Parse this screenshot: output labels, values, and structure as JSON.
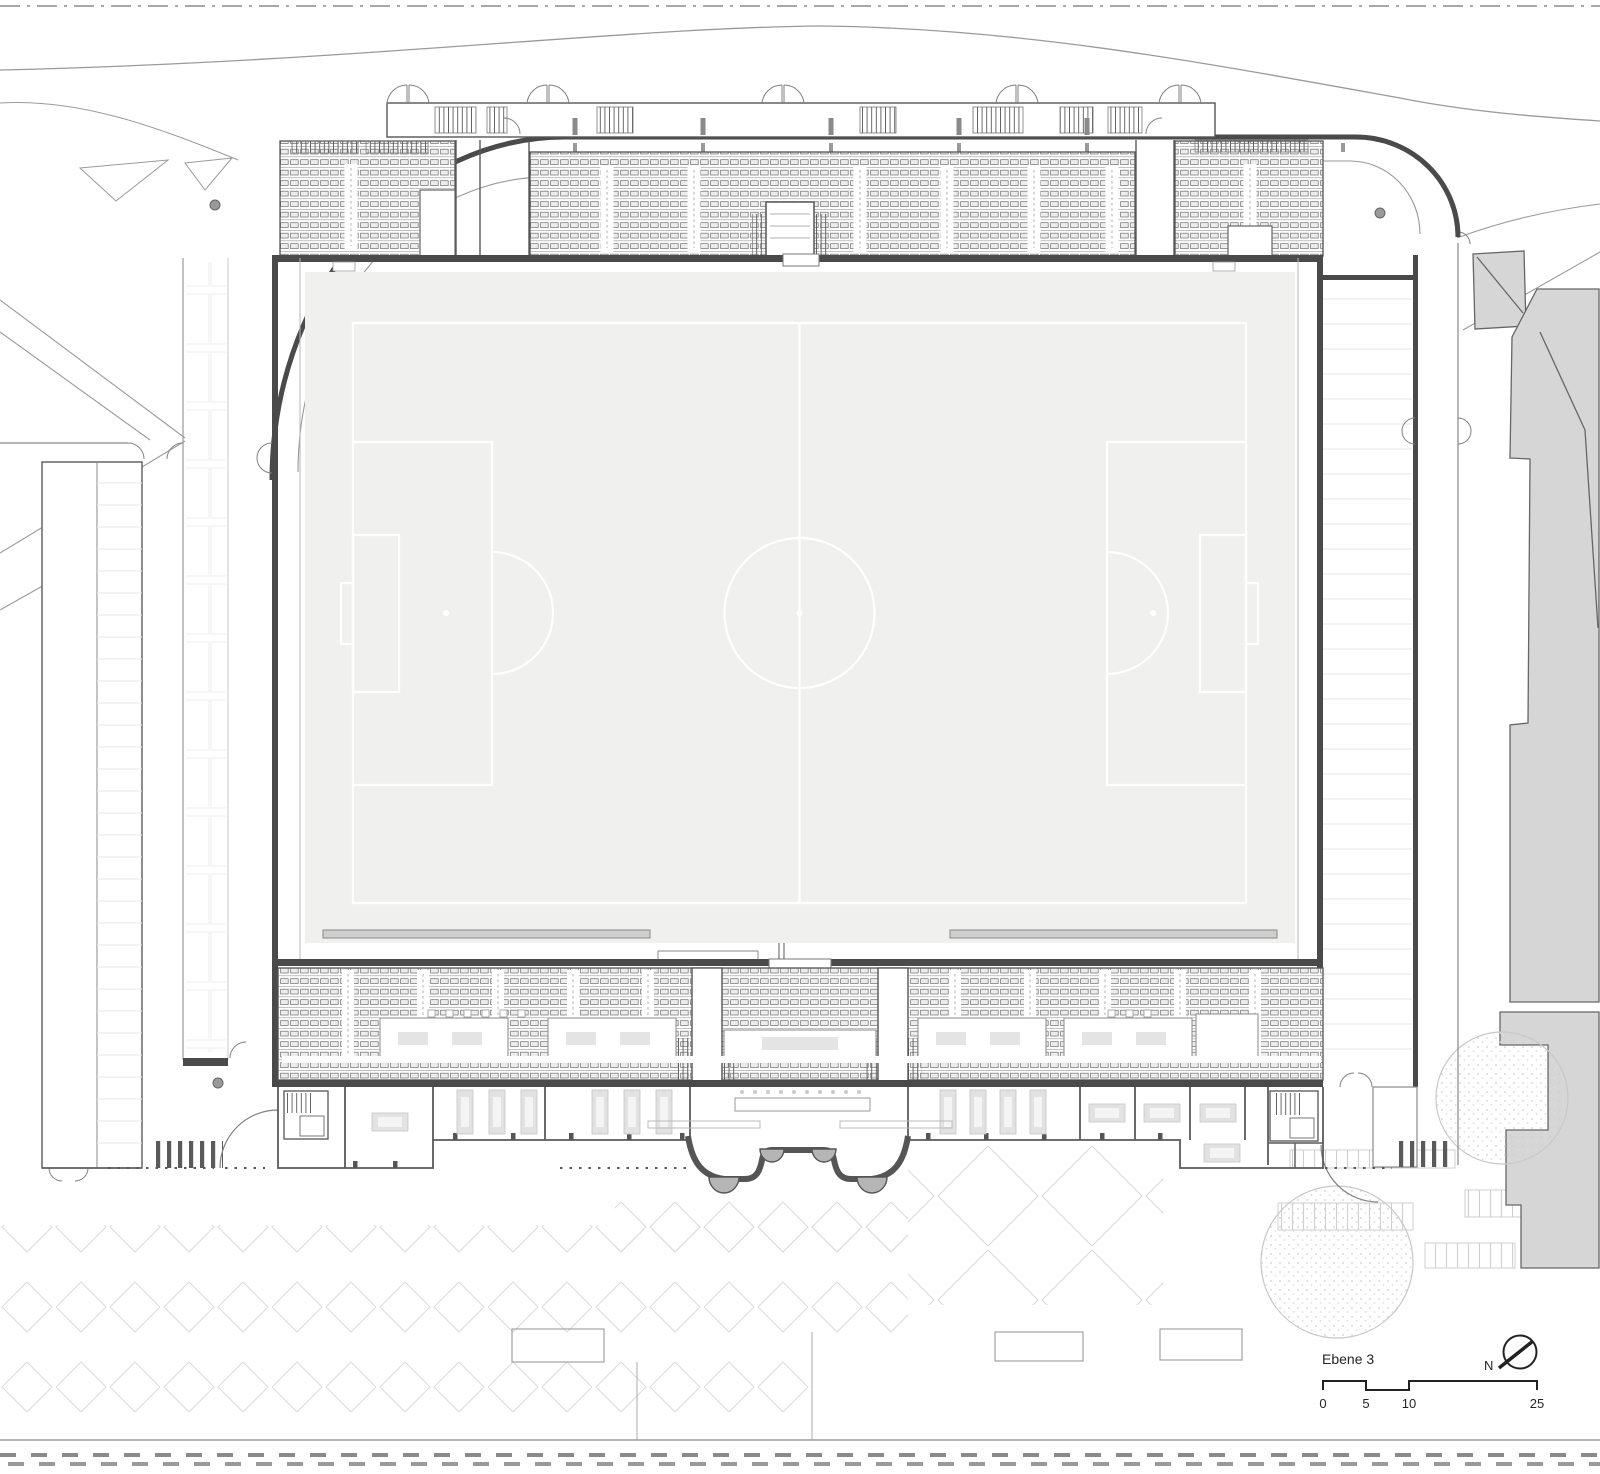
{
  "drawing": {
    "type_label": "stadium-floor-plan",
    "level_label": "Ebene 3",
    "compass": {
      "icon": "north-arrow-icon",
      "label": "N"
    },
    "scale_bar": {
      "unit": "m",
      "ticks": [
        "0",
        "5",
        "10",
        "25"
      ]
    },
    "colors": {
      "wall": "#4a4a4a",
      "line_medium": "#777777",
      "line_light": "#bbbbbb",
      "line_faint": "#e7e7e7",
      "pitch_fill": "#f0f0ef",
      "pitch_marking": "#ffffff",
      "context_building_fill": "#d6d6d6",
      "seat_stroke": "#6e6e6e",
      "paving": "#d9d9d9",
      "pod_fill": "#b5b5b5"
    }
  }
}
